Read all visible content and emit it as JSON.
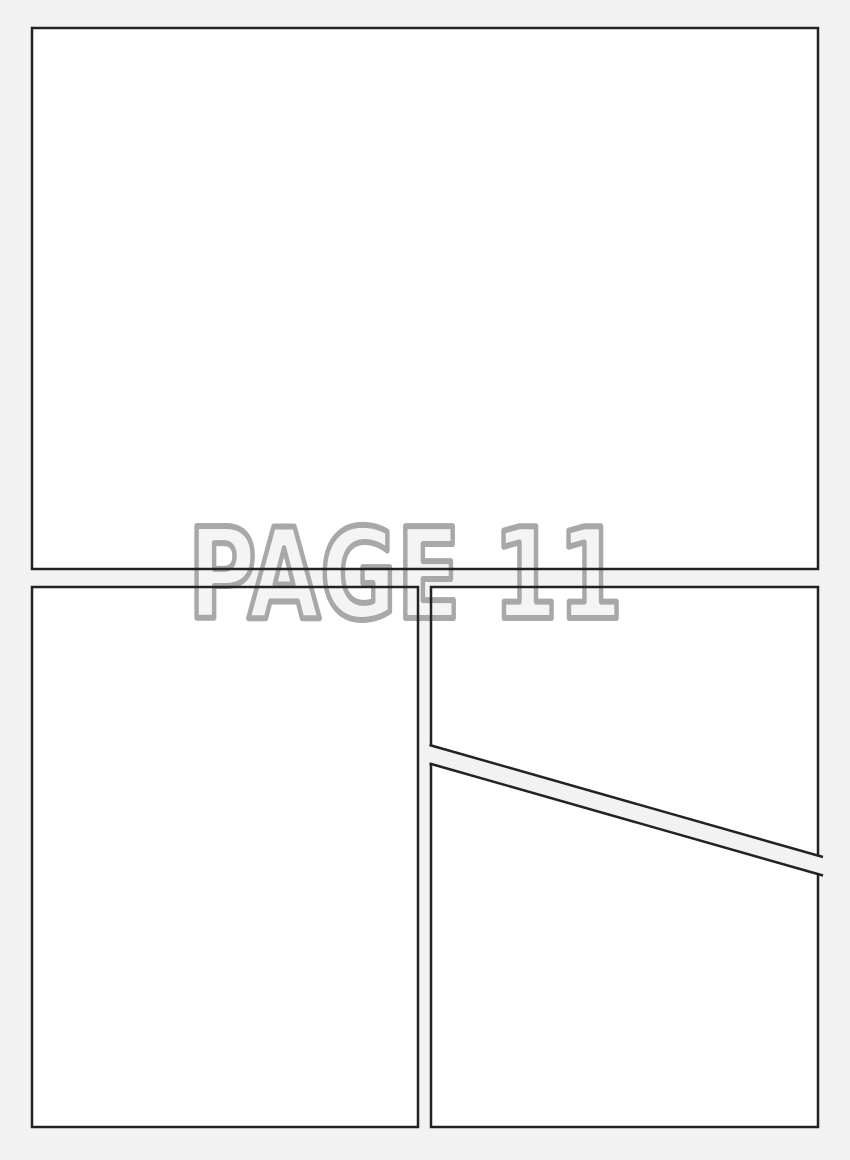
{
  "page": {
    "watermark_text": "PAGE 11",
    "colors": {
      "background": "#f2f2f2",
      "panel_fill": "#ffffff",
      "panel_border": "#222222",
      "watermark_fill": "#f4f4f4",
      "watermark_outline": "#a8a8a8"
    }
  }
}
